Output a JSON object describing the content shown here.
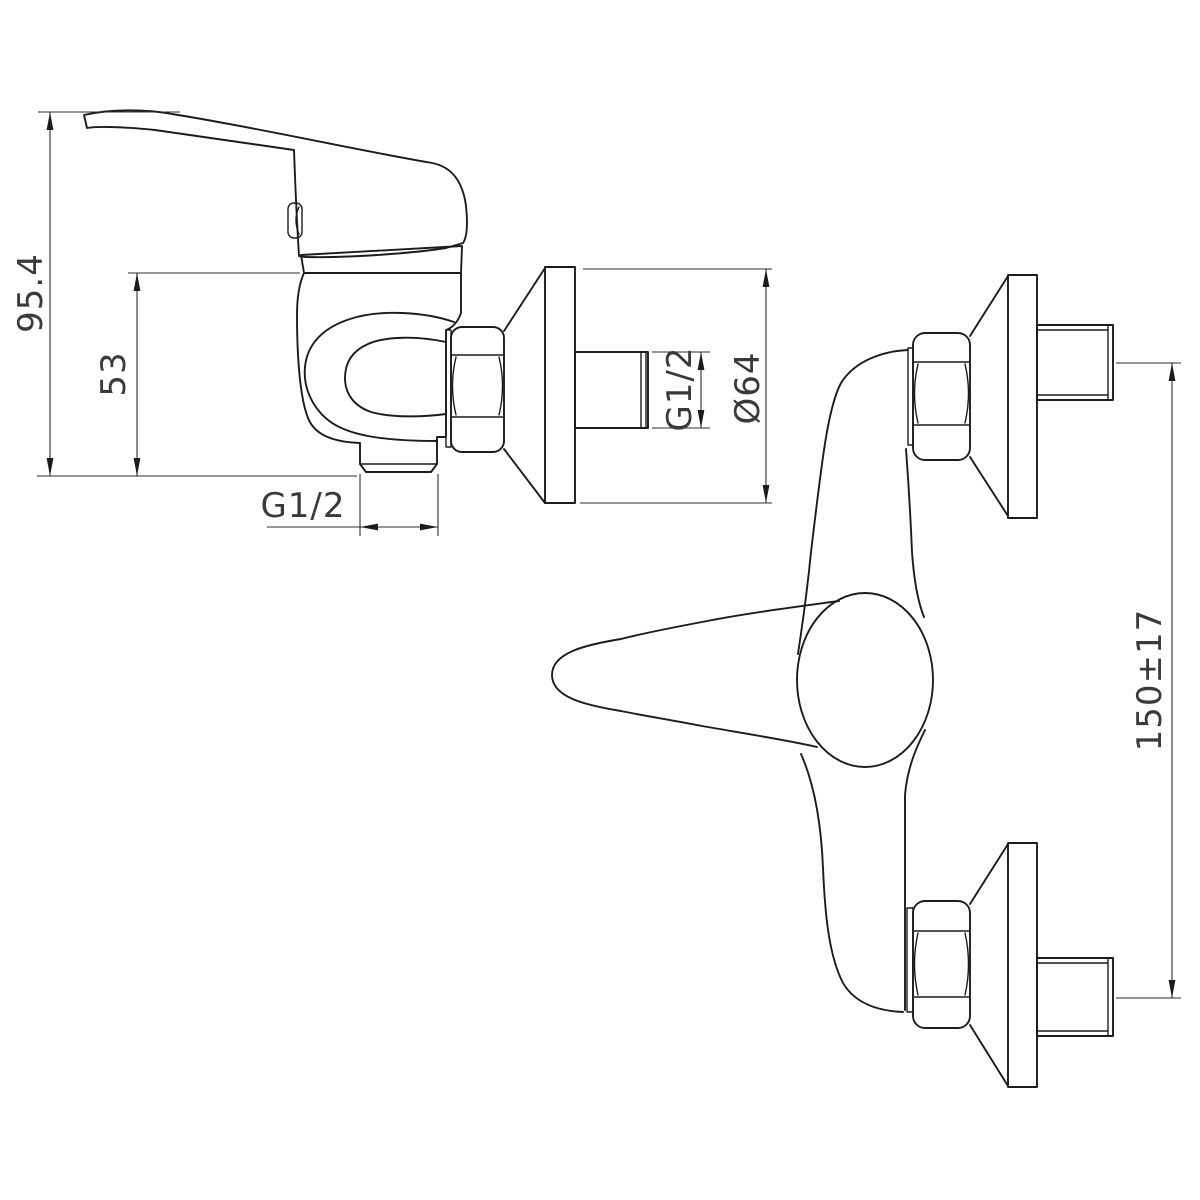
{
  "drawing": {
    "background_color": "#ffffff",
    "line_color": "#1c1c1c",
    "dimension_text_color": "#3a3a3a"
  },
  "views": {
    "side": {
      "dims": {
        "overall_height": "95.4",
        "body_height": "53",
        "outlet_thread": "G1/2",
        "inlet_thread": "G1/2",
        "flange_diameter": "Ø64"
      }
    },
    "front": {
      "dims": {
        "centers_distance": "150±17"
      }
    }
  }
}
